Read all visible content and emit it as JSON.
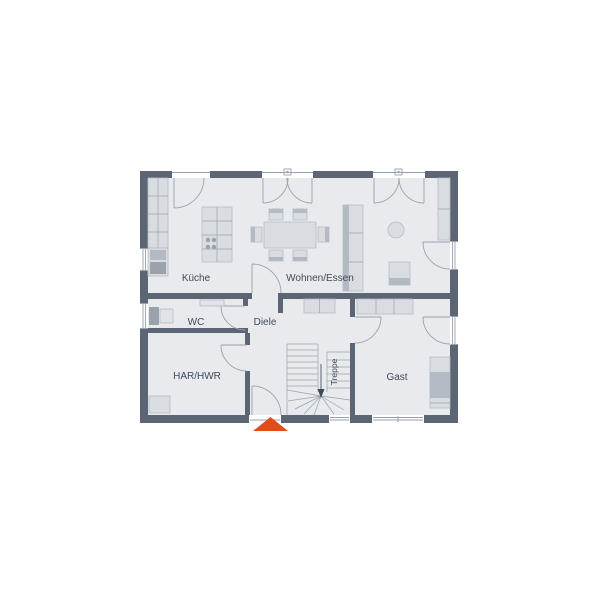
{
  "rooms": {
    "kueche": {
      "label": "Küche"
    },
    "wohnen": {
      "label": "Wohnen/Essen"
    },
    "wc": {
      "label": "WC"
    },
    "diele": {
      "label": "Diele"
    },
    "har": {
      "label": "HAR/HWR"
    },
    "treppe": {
      "label": "Treppe"
    },
    "gast": {
      "label": "Gast"
    }
  },
  "colors": {
    "wall": "#5c6573",
    "floor": "#e8eaee",
    "furn": "#d9dde2",
    "furn-stroke": "#b6bcc6",
    "furn-dark": "#b3bac4",
    "line": "#9aa2ad",
    "frame": "#99a1ac",
    "text": "#3f4a58",
    "accent": "#e64a19"
  }
}
